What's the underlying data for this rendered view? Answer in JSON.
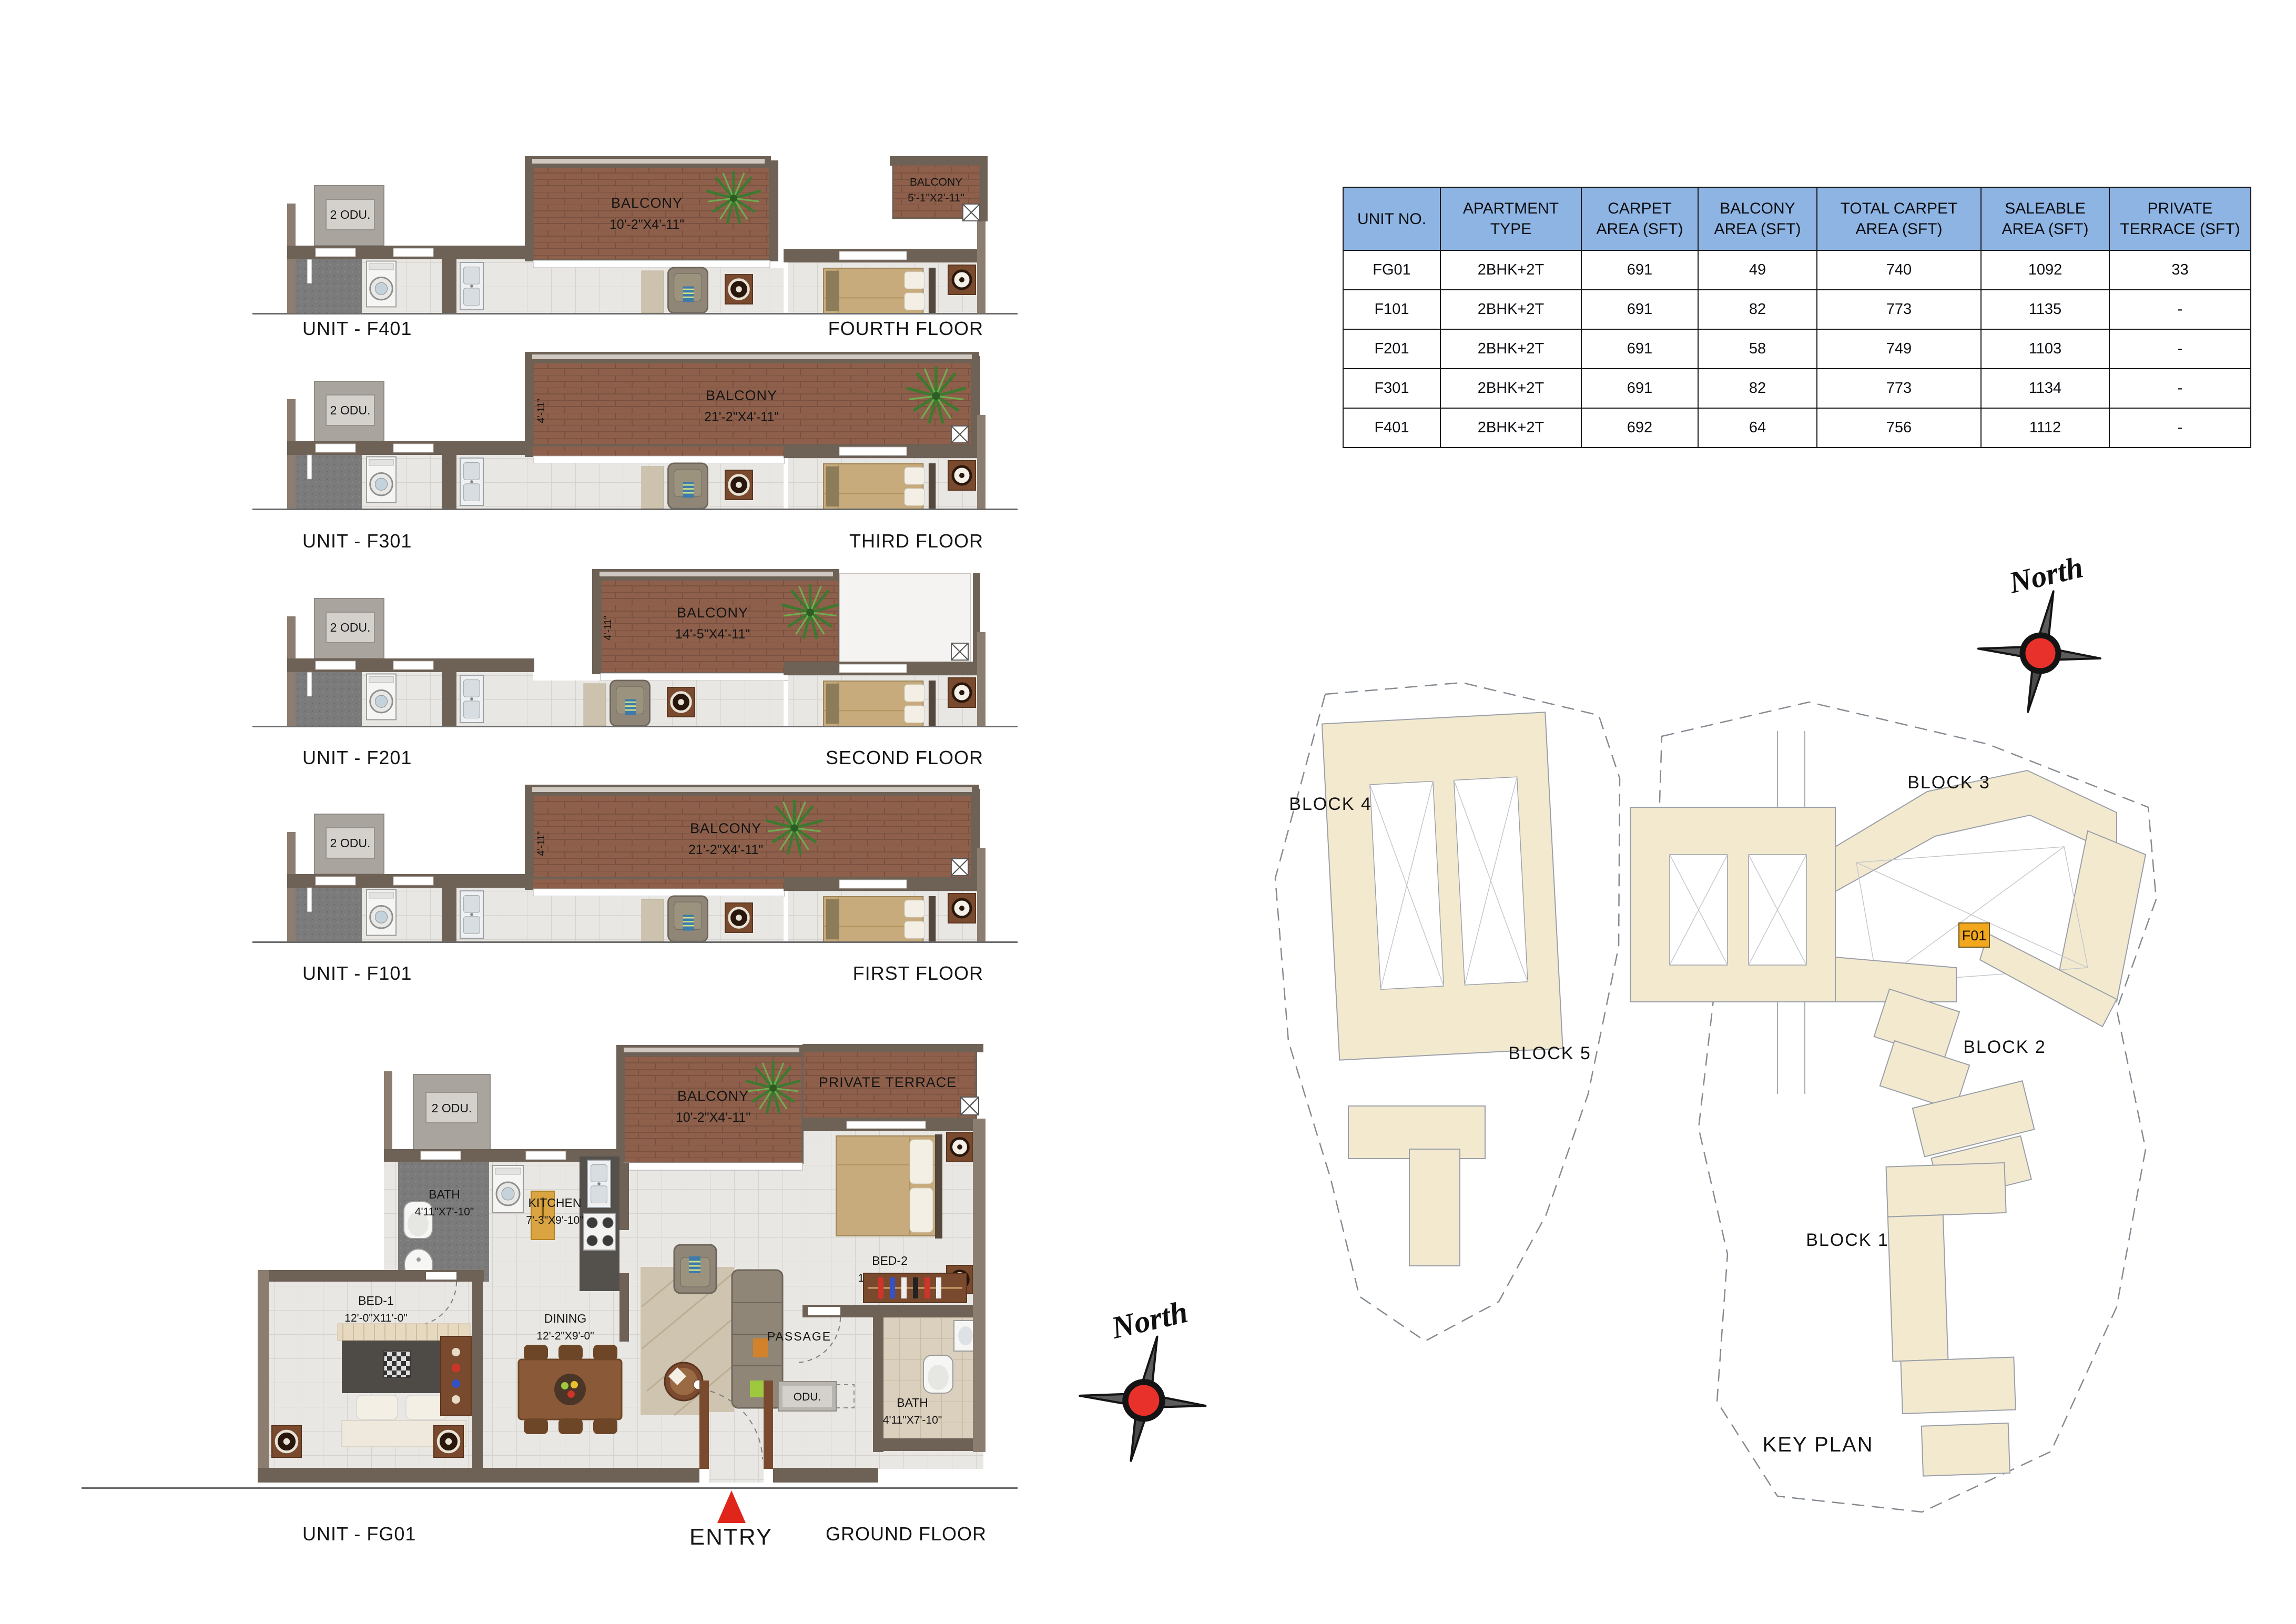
{
  "table": {
    "headers": [
      "UNIT NO.",
      "APARTMENT TYPE",
      "CARPET AREA (SFT)",
      "BALCONY AREA (SFT)",
      "TOTAL CARPET AREA (SFT)",
      "SALEABLE AREA (SFT)",
      "PRIVATE TERRACE (SFT)"
    ],
    "rows": [
      [
        "FG01",
        "2BHK+2T",
        "691",
        "49",
        "740",
        "1092",
        "33"
      ],
      [
        "F101",
        "2BHK+2T",
        "691",
        "82",
        "773",
        "1135",
        "-"
      ],
      [
        "F201",
        "2BHK+2T",
        "691",
        "58",
        "749",
        "1103",
        "-"
      ],
      [
        "F301",
        "2BHK+2T",
        "691",
        "82",
        "773",
        "1134",
        "-"
      ],
      [
        "F401",
        "2BHK+2T",
        "692",
        "64",
        "756",
        "1112",
        "-"
      ]
    ]
  },
  "floors": [
    {
      "unit_label": "UNIT - F401",
      "floor_label": "FOURTH FLOOR",
      "odu_label": "2 ODU.",
      "balcony_label": "BALCONY",
      "balcony_dim": "10'-2\"X4'-11\"",
      "balcony2_label": "BALCONY",
      "balcony2_dim": "5'-1\"X2'-11\""
    },
    {
      "unit_label": "UNIT - F301",
      "floor_label": "THIRD FLOOR",
      "odu_label": "2 ODU.",
      "balcony_label": "BALCONY",
      "balcony_dim": "21'-2\"X4'-11\"",
      "balcony_side_dim": "4'-11\""
    },
    {
      "unit_label": "UNIT - F201",
      "floor_label": "SECOND FLOOR",
      "odu_label": "2 ODU.",
      "balcony_label": "BALCONY",
      "balcony_dim": "14'-5\"X4'-11\"",
      "balcony_side_dim": "4'-11\""
    },
    {
      "unit_label": "UNIT - F101",
      "floor_label": "FIRST FLOOR",
      "odu_label": "2 ODU.",
      "balcony_label": "BALCONY",
      "balcony_dim": "21'-2\"X4'-11\"",
      "balcony_side_dim": "4'-11\""
    }
  ],
  "ground": {
    "unit_label": "UNIT - FG01",
    "floor_label": "GROUND FLOOR",
    "entry_label": "ENTRY",
    "odu_label": "2 ODU.",
    "odu_small_label": "ODU.",
    "balcony_label": "BALCONY",
    "balcony_dim": "10'-2\"X4'-11\"",
    "terrace_label": "PRIVATE TERRACE",
    "rooms": {
      "bath1_name": "BATH",
      "bath1_dim": "4'11\"X7'-10\"",
      "kitchen_name": "KITCHEN",
      "kitchen_dim": "7'-3\"X9'-10\"",
      "bed2_name": "BED-2",
      "bed2_dim": "10'-0\"X13'-0\"",
      "bed1_name": "BED-1",
      "bed1_dim": "12'-0\"X11'-0\"",
      "dining_name": "DINING",
      "dining_dim": "12'-2\"X9'-0\"",
      "living_name": "LIVING",
      "living_dim": "10'-4\"X11'-4\"",
      "passage_name": "PASSAGE",
      "bath2_name": "BATH",
      "bath2_dim": "4'11\"X7'-10\""
    }
  },
  "key_plan": {
    "title": "KEY PLAN",
    "north_label": "North",
    "block1": "BLOCK 1",
    "block2": "BLOCK 2",
    "block3": "BLOCK 3",
    "block4": "BLOCK 4",
    "block5": "BLOCK 5",
    "highlight_unit": "F01"
  },
  "colors": {
    "table_header_bg": "#8db4e2",
    "wall": "#6e6156",
    "balcony_floor": "#8e604b",
    "building_fill": "#f3e9cf",
    "highlight_orange": "#f2a71f",
    "compass_red": "#e8312a",
    "entry_red": "#e0251b"
  }
}
